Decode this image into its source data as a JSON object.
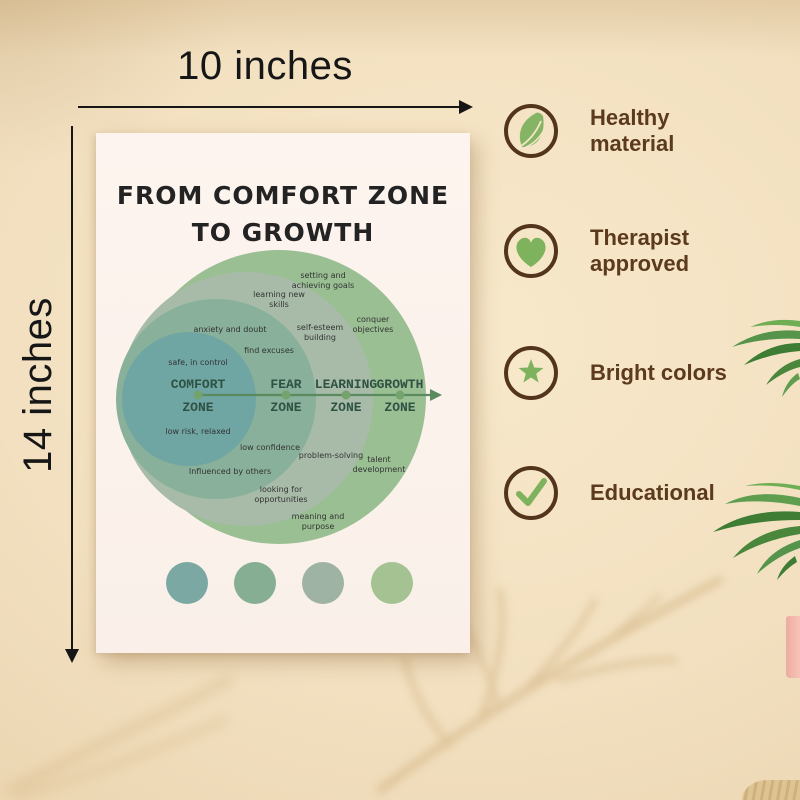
{
  "scene": {
    "width_label": "10 inches",
    "height_label": "14 inches"
  },
  "poster": {
    "title_line1": "FROM COMFORT ZONE",
    "title_line2": "TO GROWTH",
    "zones": [
      {
        "name_top": "COMFORT",
        "name_bottom": "ZONE",
        "color": "#6fa5a3"
      },
      {
        "name_top": "FEAR",
        "name_bottom": "ZONE",
        "color": "#88b09a"
      },
      {
        "name_top": "LEARNING",
        "name_bottom": "ZONE",
        "color": "#a8bba9"
      },
      {
        "name_top": "GROWTH",
        "name_bottom": "ZONE",
        "color": "#9abf93"
      }
    ],
    "labels": [
      "setting and achieving goals",
      "learning new skills",
      "conquer objectives",
      "anxiety and doubt",
      "self-esteem building",
      "find excuses",
      "safe, in control",
      "low risk, relaxed",
      "low confidence",
      "problem-solving",
      "talent development",
      "Influenced by others",
      "looking for opportunities",
      "meaning and purpose"
    ],
    "swatches": [
      "#7ba8a3",
      "#86ae93",
      "#9fb3a5",
      "#a5c293"
    ]
  },
  "features": [
    {
      "icon": "leaf-icon",
      "line1": "Healthy",
      "line2": "material"
    },
    {
      "icon": "heart-icon",
      "line1": "Therapist",
      "line2": "approved"
    },
    {
      "icon": "star-icon",
      "line1": "Bright colors",
      "line2": ""
    },
    {
      "icon": "check-icon",
      "line1": "Educational",
      "line2": ""
    }
  ],
  "palette": {
    "wall": "#f1dfc0",
    "poster_bg": "#fcf2ec",
    "axis_green": "#5a8a5e",
    "zone_text": "#2f5244",
    "icon_ring_brown": "#53341d",
    "icon_green": "#7fb25c",
    "feature_text_brown": "#5c3a1d",
    "dimension_ink": "#161616",
    "plant_green": "#3f7d35"
  }
}
